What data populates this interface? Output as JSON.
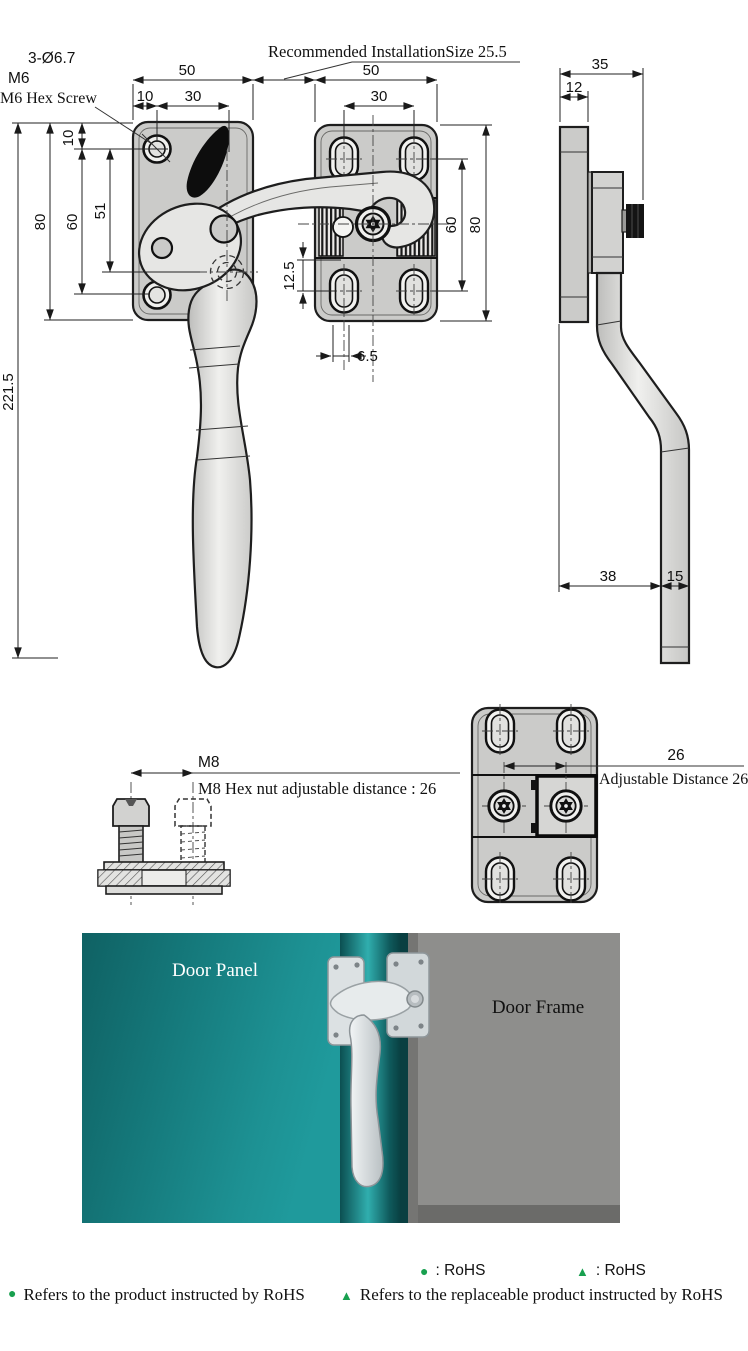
{
  "drawing": {
    "notes": {
      "install": "Recommended InstallationSize 25.5",
      "hole_spec": "3-Ø6.7",
      "thread": "M6",
      "screw": "M6 Hex Screw",
      "m8": "M8",
      "m8_note": "M8 Hex nut adjustable distance : 26",
      "adjustable": "Adjustable Distance 26"
    },
    "dims": {
      "fl_width": "50",
      "fl_edge": "10",
      "fl_holes_h": "30",
      "fl_top": "10",
      "fl_holes_v": "60",
      "fl_pivot": "51",
      "fl_height": "80",
      "total_length": "221.5",
      "fr_width": "50",
      "fr_holes_h": "30",
      "fr_holes_v": "60",
      "fr_height": "80",
      "fr_slot_v": "12.5",
      "fr_slot_h": "6.5",
      "sv_depth": "35",
      "sv_plate": "12",
      "sv_offset": "38",
      "sv_handle": "15",
      "adj_distance": "26"
    }
  },
  "render": {
    "door_panel": "Door Panel",
    "door_frame": "Door Frame"
  },
  "legend": {
    "green": "#18a04f",
    "row1": [
      {
        "symbol": "●",
        "label": ": RoHS"
      },
      {
        "symbol": "▲",
        "label": ": RoHS"
      }
    ],
    "row2": [
      {
        "symbol": "●",
        "label": "Refers to the product instructed by RoHS"
      },
      {
        "symbol": "▲",
        "label": "Refers to the replaceable product instructed by RoHS"
      }
    ]
  }
}
